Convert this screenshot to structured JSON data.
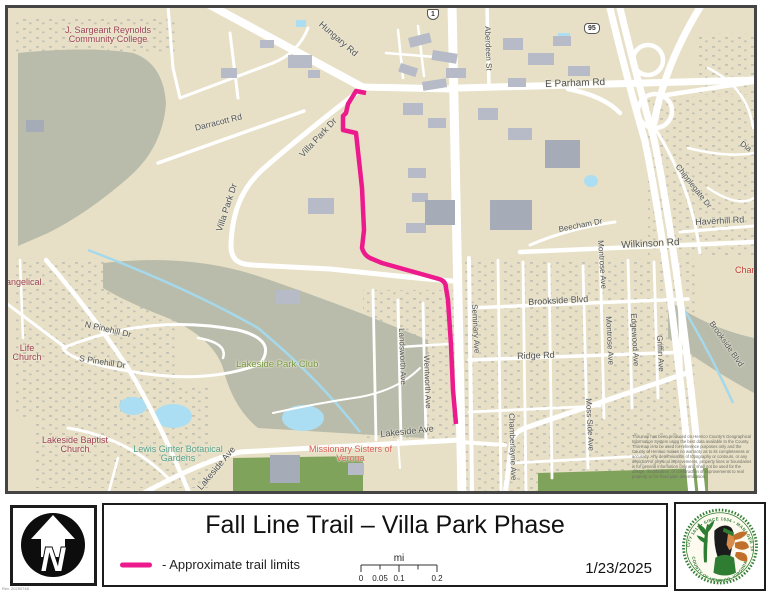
{
  "title": "Fall Line Trail – Villa Park Phase",
  "date": "1/23/2025",
  "legend": {
    "trail_label": "- Approximate trail limits"
  },
  "scalebar": {
    "unit": "mi",
    "ticks": [
      "0",
      "0.05",
      "0.1",
      "0.2"
    ]
  },
  "north": {
    "letter": "N"
  },
  "seal": {
    "top_text": "CITY 1611 • SINCE 1634 • MANAGER 1934",
    "bottom_text": "COUNTY OF HENRICO, VIRGINIA"
  },
  "rev_note": "Rev. 20250748",
  "colors": {
    "trail": "#ec1a8d",
    "water": "#abdef2",
    "forest": "#b9bcaa",
    "park_green": "#80a35c",
    "seal_green": "#2f7d33"
  },
  "map": {
    "disclaimer": "This map has been produced on Henrico County's Geographical Information System using the best data available to the County. This map is to be used for reference purposes only and the County of Henrico makes no warranty as to its completeness or accuracy. Any determination of topography or contours, or any depiction of physical improvements, property lines or boundaries is for general information only and shall not be used for the design, modification, or construction of improvements to real property or for flood plain determination.",
    "labels": {
      "hungary_rd": "Hungary Rd",
      "us1_shield": "1",
      "i95_shield": "95",
      "aberdeen_st": "Aberdeen St",
      "e_parham_rd": "E Parham Rd",
      "jsrcc": "J. Sargeant Reynolds\nCommunity College",
      "darracott_rd": "Darracott Rd",
      "villa_park_dr_1": "Villa Park Dr",
      "villa_park_dr_2": "Villa Park Dr",
      "chipplegate_dr": "Chipplegate Dr",
      "haverhill_rd": "Haverhill Rd",
      "wilkinson_rd": "Wilkinson Rd",
      "beecham_dr": "Beecham Dr",
      "montrose_ave_1": "Montrose Ave",
      "montrose_ave_2": "Montrose Ave",
      "edgewood_ave": "Edgewood Ave",
      "griffin_ave": "Griffin Ave",
      "moss_side_ave": "Moss Side Ave",
      "seminary_ave": "Seminary Ave",
      "brookside_blvd_1": "Brookside Blvd",
      "brookside_blvd_2": "Brookside Blvd",
      "ridge_rd": "Ridge Rd",
      "chamberlayne_ave": "Chamberlayne Ave",
      "landsworth_ave": "Landsworth Ave",
      "wentworth_ave": "Wentworth Ave",
      "lakeside_ave_1": "Lakeside Ave",
      "lakeside_ave_2": "Lakeside Ave",
      "missionary_sisters": "Missionary Sisters of\nVerona",
      "lakeside_park_club": "Lakeside Park Club",
      "lewis_ginter": "Lewis Ginter Botanical\nGardens",
      "lakeside_baptist": "Lakeside Baptist\nChurch",
      "n_pinehill_dr": "N Pinehill Dr",
      "s_pinehill_dr": "S Pinehill Dr",
      "evangelical_frag": "angelical",
      "life_church": "Life\nChurch",
      "diamond_frag": "Dia",
      "chamberlayne_frag": "Chamb"
    }
  }
}
